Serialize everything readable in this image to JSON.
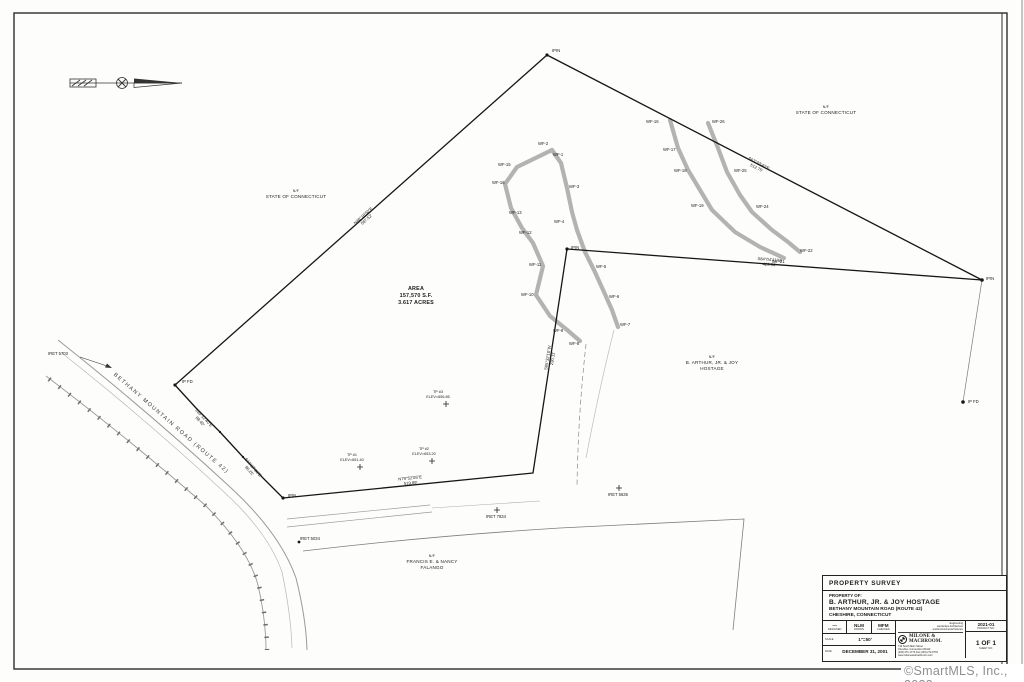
{
  "watermark": "©SmartMLS, Inc., 2023",
  "sheet": {
    "area": {
      "title": "AREA",
      "sf": "157,570 S.F.",
      "acres": "3.617 ACRES"
    },
    "road_name": "BETHANY MOUNTAIN ROAD  (ROUTE 42)",
    "adjoiners": {
      "state_west": {
        "nf": "N/F",
        "name": "STATE OF CONNECTICUT"
      },
      "state_east": {
        "nf": "N/F",
        "name": "STATE OF CONNECTICUT"
      },
      "hostage": {
        "nf": "N/F",
        "line1": "B. ARTHUR, JR. & JOY",
        "line2": "HOSTAGE"
      },
      "falango": {
        "nf": "N/F",
        "line1": "FRANCIS E. & NANCY",
        "line2": "FALANGO"
      }
    },
    "bearings": {
      "west": {
        "b": "N48°18'50\"E",
        "d": "587.52'"
      },
      "north": {
        "b": "S62°33'40\"E",
        "d": "512.75'"
      },
      "east": {
        "b": "S84°04'41\"W",
        "d": "429.84'"
      },
      "interior": {
        "b": "S05°32'10\"W",
        "d": "230.11'"
      },
      "south": {
        "b": "N79°52'05\"E",
        "d": "519.89'"
      },
      "front1": {
        "b": "S35°12'40\"E",
        "d": "88.40'"
      },
      "front2": {
        "b": "S44°27'30\"E",
        "d": "96.25'"
      }
    },
    "monuments": {
      "ipin_top": "IPIN",
      "ipfd_left": "IP FD",
      "ipin_right": "IPIN",
      "ipfd_right": "IP FD",
      "ipin_mid": "IPIN",
      "ipin_bottom": "IPIN",
      "iret_5703": "IRET 5703",
      "iret_5034": "IRET 5034",
      "iret_7834": "IRET 7834",
      "iret_5635": "IRET 5635"
    },
    "spot_elevations": [
      {
        "tp": "TP #1",
        "elev": "ELEV=651.40"
      },
      {
        "tp": "TP #2",
        "elev": "ELEV=653.20"
      },
      {
        "tp": "TP #3",
        "elev": "ELEV=656.85"
      }
    ],
    "flags": {
      "wf1": "WF-1",
      "wf2": "WF-2",
      "wf3": "WF-3",
      "wf4": "WF-4",
      "wf5": "WF-5",
      "wf6": "WF-6",
      "wf7": "WF-7",
      "wf8": "WF-8",
      "wf9": "WF-9",
      "wf10": "WF-10",
      "wf11": "WF-11",
      "wf12": "WF-12",
      "wf13": "WF-13",
      "wf15": "WF-15",
      "wf16": "WF-16",
      "wf16r": "WF-16",
      "wf17": "WF-17",
      "wf18": "WF-18",
      "wf19": "WF-19",
      "wf21": "WF-21",
      "wf22": "WF-22",
      "wf24": "WF-24",
      "wf25": "WF-25",
      "wf26": "WF-26"
    }
  },
  "title_block": {
    "title": "PROPERTY SURVEY",
    "property_of_label": "PROPERTY OF:",
    "owner": "B. ARTHUR, JR. & JOY HOSTAGE",
    "address": "BETHANY MOUNTAIN ROAD (ROUTE 42)",
    "city": "CHESHIRE, CONNECTICUT",
    "designed": "—",
    "designed_label": "DESIGNED",
    "drawn": "NLM",
    "drawn_label": "DRAWN",
    "checked": "MFM",
    "checked_label": "CHECKED",
    "scale_label": "SCALE",
    "scale": "1\"=50'",
    "date_label": "DATE",
    "date": "DECEMBER 31, 2001",
    "firm": {
      "name": "MILONE & MACBROOM.",
      "tag1": "Engineering",
      "tag2": "Landscape Architecture",
      "tag3": "and Environmental Science",
      "addr1": "716 South Main Street",
      "addr2": "Cheshire, Connecticut 06410",
      "addr3": "(203) 271-1773  Fax (203) 272-9733",
      "addr4": "www.miloneandmacbroom.com"
    },
    "project_no": "2021-01",
    "project_no_label": "PROJECT NO.",
    "sheet_no": "1 OF 1",
    "sheet_no_label": "SHEET NO."
  }
}
